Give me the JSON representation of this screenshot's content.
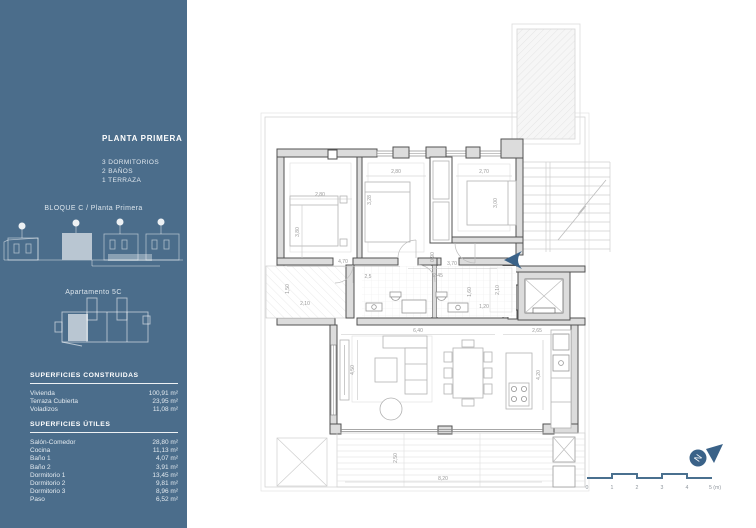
{
  "sidebar": {
    "background": "#4b6d8b",
    "highlight_color": "#b9c6d2",
    "title": "PLANTA PRIMERA",
    "program": [
      "3 DORMITORIOS",
      "2 BAÑOS",
      "1 TERRAZA"
    ],
    "block_label": "BLOQUE C / Planta Primera",
    "apartment_label": "Apartamento 5C",
    "superficies_construidas": {
      "heading": "SUPERFICIES CONSTRUIDAS",
      "rows": [
        {
          "label": "Vivienda",
          "value": "100,91 m²"
        },
        {
          "label": "Terraza Cubierta",
          "value": "23,95 m²"
        },
        {
          "label": "Voladizos",
          "value": "11,08 m²"
        }
      ]
    },
    "superficies_utiles": {
      "heading": "SUPERFICIES ÚTILES",
      "rows": [
        {
          "label": "Salón-Comedor",
          "value": "28,80 m²"
        },
        {
          "label": "Cocina",
          "value": "11,13 m²"
        },
        {
          "label": "Baño 1",
          "value": "4,07 m²"
        },
        {
          "label": "Baño 2",
          "value": "3,91 m²"
        },
        {
          "label": "Dormitorio 1",
          "value": "13,45 m²"
        },
        {
          "label": "Dormitorio 2",
          "value": "9,81 m²"
        },
        {
          "label": "Dormitorio 3",
          "value": "8,96 m²"
        },
        {
          "label": "Paso",
          "value": "6,52 m²"
        }
      ]
    }
  },
  "plan": {
    "accent_color": "#3a6288",
    "dimensions": {
      "d1_w": "2,80",
      "d1_h": "3,80",
      "d2_w": "2,80",
      "d2_h": "3,28",
      "d3_w": "2,70",
      "d3_h": "3,00",
      "hall_w": "4,70",
      "bath1_w": "2,5",
      "bath2_w": "2,45",
      "entry_w": "3,70",
      "door_h": "0,90",
      "entry_h": "2,10",
      "entry_d": "1,20",
      "bath2_h": "1,60",
      "balcony_h": "1,50",
      "balcony_w": "2,10",
      "living_w": "6,40",
      "living_h": "4,50",
      "kitchen_w": "2,65",
      "kitchen_h": "4,20",
      "terrace_h": "2,50",
      "terrace_w": "8,20"
    }
  },
  "scale_bar": {
    "labels": [
      "0",
      "1",
      "2",
      "3",
      "4",
      "5 (m)"
    ],
    "north_letter": "N"
  }
}
